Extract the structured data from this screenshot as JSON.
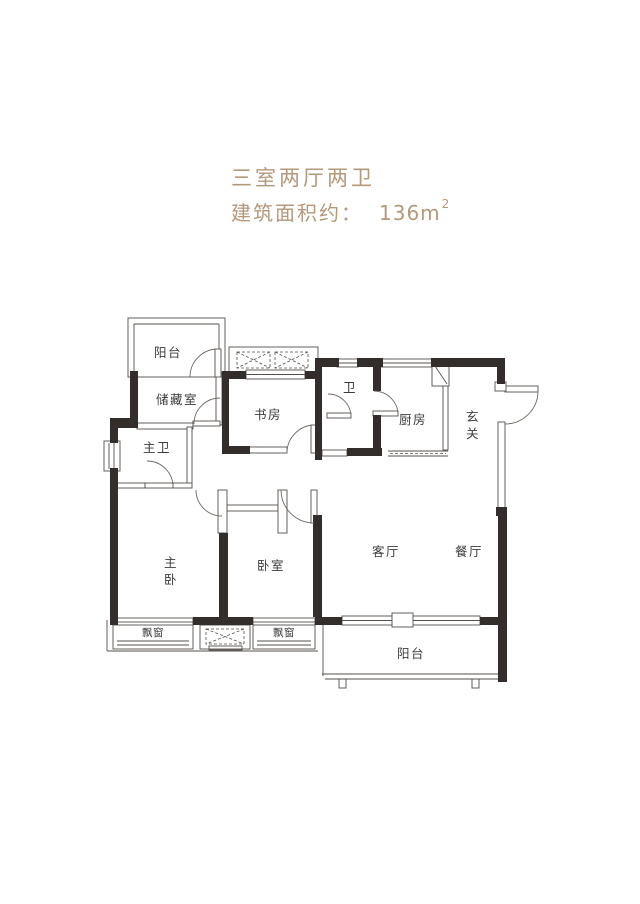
{
  "header": {
    "title": "三室两厅两卫",
    "area_label": "建筑面积约：",
    "area_value": "136m",
    "area_sup": "2",
    "text_color": "#b4987a"
  },
  "floorplan": {
    "wall_color": "#332e2b",
    "line_color": "#55504b",
    "label_color": "#3b3b3b",
    "rooms": {
      "balcony_top": {
        "label": "阳台"
      },
      "storage": {
        "label": "储藏室"
      },
      "study": {
        "label": "书房"
      },
      "bath": {
        "label": "卫"
      },
      "kitchen": {
        "label": "厨房"
      },
      "entry": {
        "label": "玄关"
      },
      "master_bath": {
        "label": "主卫"
      },
      "master_bedroom": {
        "label": "主卧"
      },
      "bedroom": {
        "label": "卧室"
      },
      "living": {
        "label": "客厅"
      },
      "dining": {
        "label": "餐厅"
      },
      "bay_window_left": {
        "label": "飘窗"
      },
      "bay_window_right": {
        "label": "飘窗"
      },
      "balcony_bottom": {
        "label": "阳台"
      }
    }
  }
}
